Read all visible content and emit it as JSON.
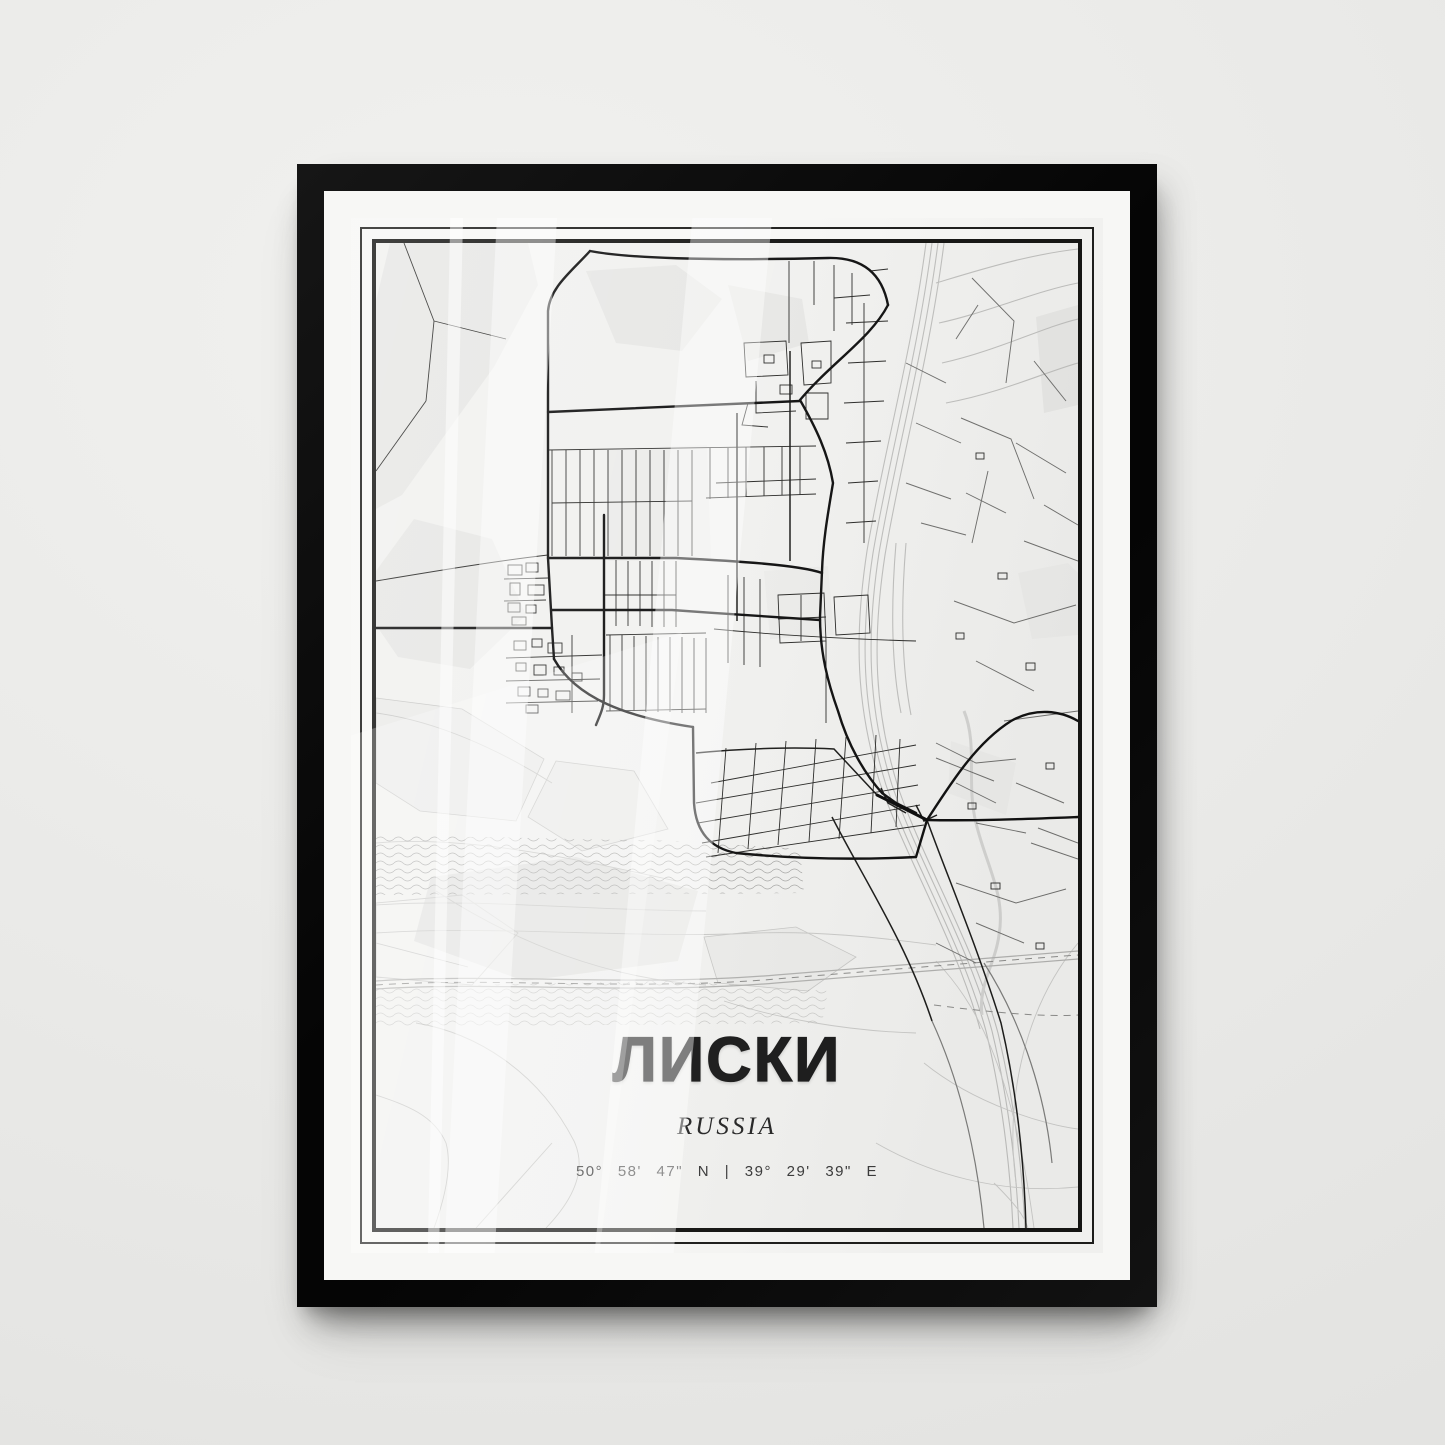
{
  "poster": {
    "title": "ЛИСКИ",
    "country": "RUSSIA",
    "coordinates": "50° 58' 47\" N | 39° 29' 39\" E"
  },
  "frame": {
    "frame_color": "#0d0d0d",
    "mat_color": "#fcfcfb",
    "border_color": "#1c1c1a"
  },
  "map": {
    "background_color": "#f1f1ef",
    "main_road_color": "#101010",
    "minor_road_color": "#2a2a28",
    "secondary_road_color": "#6f6f6d",
    "railway_color": "#bfbfbd",
    "water_line_color": "#a5a5a3",
    "area_fill_color": "#e7e7e5"
  },
  "text_colors": {
    "title": "#1b1b1b",
    "country": "#262626",
    "coordinates": "#3a3a3a"
  }
}
